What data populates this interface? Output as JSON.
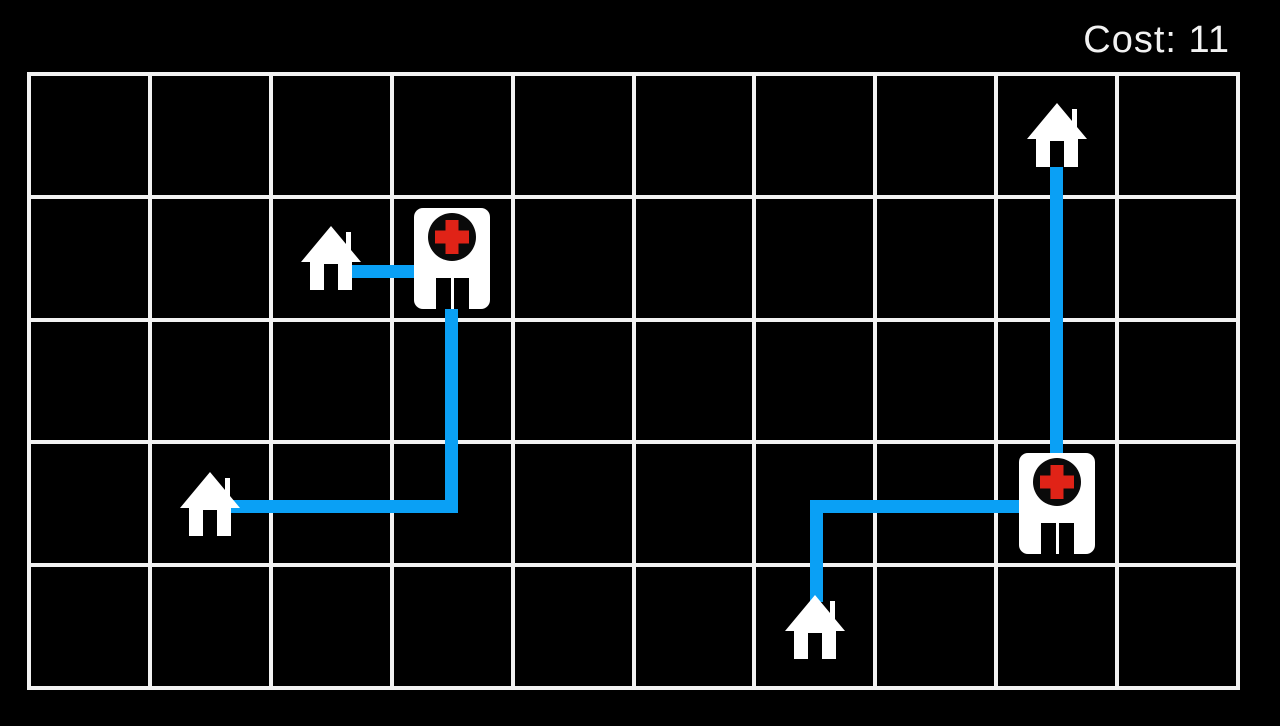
{
  "hud": {
    "cost_label": "Cost: 11",
    "cost_value": 11
  },
  "colors": {
    "background": "#000000",
    "grid_line": "#f2f2f2",
    "route": "#0aa0f5",
    "building_fill": "#ffffff",
    "cross_red": "#e02317",
    "cross_circle": "#0a0a0a",
    "hud_text": "#f2f2f2"
  },
  "board": {
    "grid": {
      "cols": 10,
      "rows": 5,
      "left": 29,
      "top": 74,
      "right": 1238,
      "bottom": 688,
      "line_width": 4
    },
    "house_size": {
      "w": 60,
      "h": 64
    },
    "hospital_size": {
      "w": 76,
      "h": 101
    },
    "houses": [
      {
        "col": 8,
        "row": 0
      },
      {
        "col": 2,
        "row": 1
      },
      {
        "col": 1,
        "row": 3
      },
      {
        "col": 6,
        "row": 4
      }
    ],
    "hospitals": [
      {
        "col": 3,
        "row": 1
      },
      {
        "col": 8,
        "row": 3
      }
    ],
    "route_segments": [
      {
        "x": 352,
        "y": 265,
        "w": 64,
        "h": 13
      },
      {
        "x": 230,
        "y": 500,
        "w": 228,
        "h": 13
      },
      {
        "x": 445,
        "y": 309,
        "w": 13,
        "h": 204
      },
      {
        "x": 810,
        "y": 500,
        "w": 13,
        "h": 102
      },
      {
        "x": 810,
        "y": 500,
        "w": 209,
        "h": 13
      },
      {
        "x": 1050,
        "y": 167,
        "w": 13,
        "h": 291
      }
    ]
  }
}
